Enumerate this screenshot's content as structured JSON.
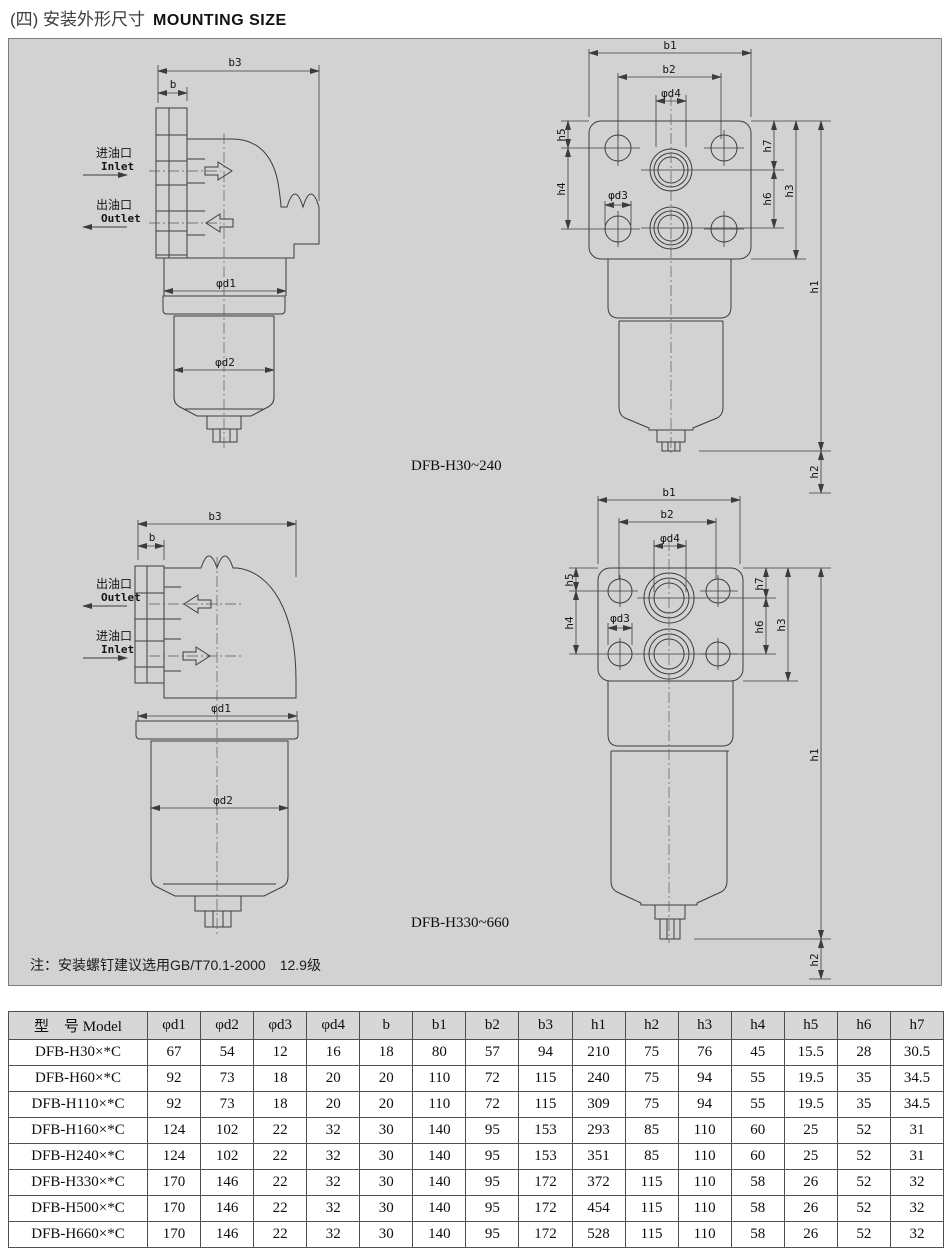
{
  "header": {
    "title_zh": "(四) 安装外形尺寸",
    "title_en": "MOUNTING SIZE"
  },
  "drawings": {
    "dims": {
      "b": "b",
      "b1": "b1",
      "b2": "b2",
      "b3": "b3",
      "d1": "φd1",
      "d2": "φd2",
      "d3": "φd3",
      "d4": "φd4",
      "h1": "h1",
      "h2": "h2",
      "h3": "h3",
      "h4": "h4",
      "h5": "h5",
      "h6": "h6",
      "h7": "h7"
    },
    "ports": {
      "inlet_zh": "进油口",
      "inlet_en": "Inlet",
      "outlet_zh": "出油口",
      "outlet_en": "Outlet"
    },
    "model_top": "DFB-H30~240",
    "model_bottom": "DFB-H330~660",
    "note": "注：安装螺钉建议选用GB/T70.1-2000　12.9级"
  },
  "table": {
    "columns": [
      "型　号 Model",
      "φd1",
      "φd2",
      "φd3",
      "φd4",
      "b",
      "b1",
      "b2",
      "b3",
      "h1",
      "h2",
      "h3",
      "h4",
      "h5",
      "h6",
      "h7"
    ],
    "rows": [
      [
        "DFB-H30×*C",
        "67",
        "54",
        "12",
        "16",
        "18",
        "80",
        "57",
        "94",
        "210",
        "75",
        "76",
        "45",
        "15.5",
        "28",
        "30.5"
      ],
      [
        "DFB-H60×*C",
        "92",
        "73",
        "18",
        "20",
        "20",
        "110",
        "72",
        "115",
        "240",
        "75",
        "94",
        "55",
        "19.5",
        "35",
        "34.5"
      ],
      [
        "DFB-H110×*C",
        "92",
        "73",
        "18",
        "20",
        "20",
        "110",
        "72",
        "115",
        "309",
        "75",
        "94",
        "55",
        "19.5",
        "35",
        "34.5"
      ],
      [
        "DFB-H160×*C",
        "124",
        "102",
        "22",
        "32",
        "30",
        "140",
        "95",
        "153",
        "293",
        "85",
        "110",
        "60",
        "25",
        "52",
        "31"
      ],
      [
        "DFB-H240×*C",
        "124",
        "102",
        "22",
        "32",
        "30",
        "140",
        "95",
        "153",
        "351",
        "85",
        "110",
        "60",
        "25",
        "52",
        "31"
      ],
      [
        "DFB-H330×*C",
        "170",
        "146",
        "22",
        "32",
        "30",
        "140",
        "95",
        "172",
        "372",
        "115",
        "110",
        "58",
        "26",
        "52",
        "32"
      ],
      [
        "DFB-H500×*C",
        "170",
        "146",
        "22",
        "32",
        "30",
        "140",
        "95",
        "172",
        "454",
        "115",
        "110",
        "58",
        "26",
        "52",
        "32"
      ],
      [
        "DFB-H660×*C",
        "170",
        "146",
        "22",
        "32",
        "30",
        "140",
        "95",
        "172",
        "528",
        "115",
        "110",
        "58",
        "26",
        "52",
        "32"
      ]
    ]
  },
  "colors": {
    "panel_bg": "#d2d2d2",
    "line": "#3c3c3c",
    "table_border": "#4f4f4f",
    "table_header_bg": "#d7d7d7"
  }
}
